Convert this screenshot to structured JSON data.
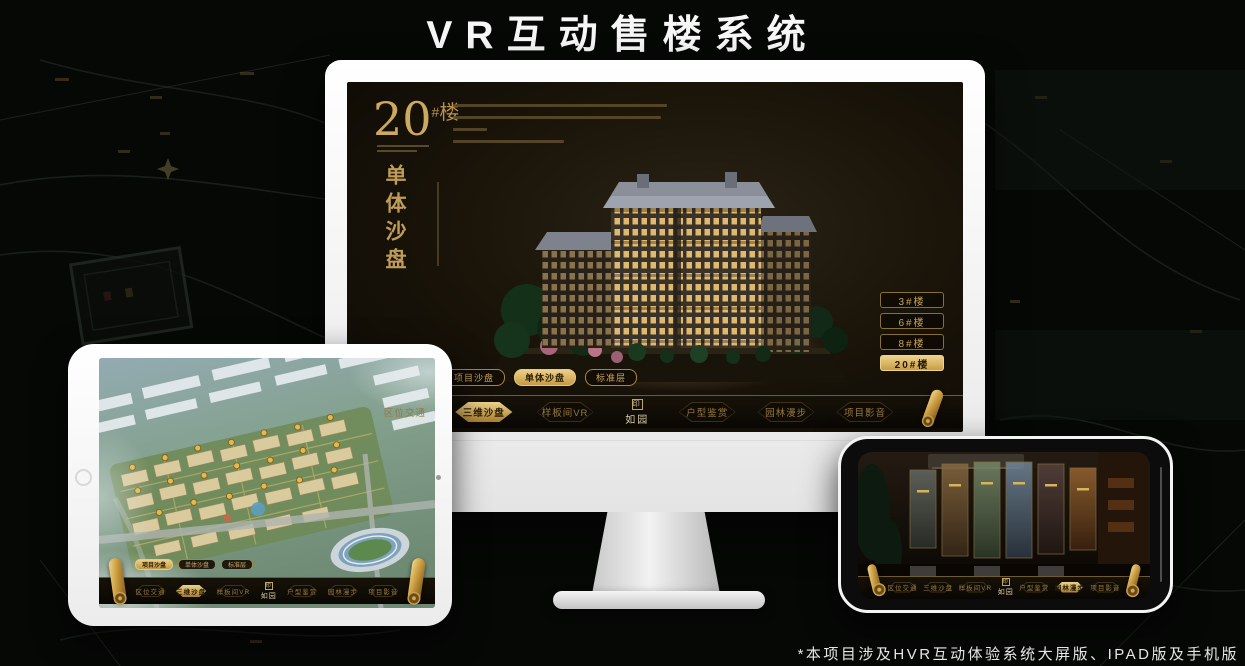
{
  "header": {
    "title": "VR互动售楼系统"
  },
  "footnote": "*本项目涉及HVR互动体验系统大屏版、IPAD版及手机版",
  "brand": {
    "name": "如园",
    "seal_glyph": "印"
  },
  "colors": {
    "gold": "#c9a45c",
    "gold_bright": "#ecd08c",
    "screen_bg": "#1a1409",
    "page_bg": "#060806"
  },
  "icons": {
    "nav_end": "scroll-icon",
    "logo_mark": "seal-icon"
  },
  "desktop": {
    "headline": {
      "number": "20",
      "hash": "#",
      "unit": "楼",
      "subtitle": "单体沙盘"
    },
    "mode_tabs": [
      {
        "label": "项目沙盘",
        "active": false
      },
      {
        "label": "单体沙盘",
        "active": true
      },
      {
        "label": "标准层",
        "active": false
      }
    ],
    "floor_buttons": [
      {
        "label": "3#楼",
        "active": false
      },
      {
        "label": "6#楼",
        "active": false
      },
      {
        "label": "8#楼",
        "active": false
      },
      {
        "label": "20#楼",
        "active": true
      }
    ],
    "nav_items": [
      {
        "label": "区位交通",
        "active": false
      },
      {
        "label": "三维沙盘",
        "active": true
      },
      {
        "label": "样板间VR",
        "active": false
      },
      {
        "label": "户型鉴赏",
        "active": false
      },
      {
        "label": "园林漫步",
        "active": false
      },
      {
        "label": "项目影音",
        "active": false
      }
    ]
  },
  "tablet": {
    "mode_tabs": [
      {
        "label": "项目沙盘",
        "active": true
      },
      {
        "label": "单体沙盘",
        "active": false
      },
      {
        "label": "标准层",
        "active": false
      }
    ],
    "nav_items": [
      {
        "label": "区位交通",
        "active": false
      },
      {
        "label": "三维沙盘",
        "active": true
      },
      {
        "label": "样板间VR",
        "active": false
      },
      {
        "label": "户型鉴赏",
        "active": false
      },
      {
        "label": "园林漫步",
        "active": false
      },
      {
        "label": "项目影音",
        "active": false
      }
    ]
  },
  "phone": {
    "nav_items": [
      {
        "label": "区位交通",
        "active": false
      },
      {
        "label": "三维沙盘",
        "active": false
      },
      {
        "label": "样板间VR",
        "active": false
      },
      {
        "label": "户型鉴赏",
        "active": false
      },
      {
        "label": "园林漫步",
        "active": true
      },
      {
        "label": "项目影音",
        "active": false
      }
    ]
  }
}
